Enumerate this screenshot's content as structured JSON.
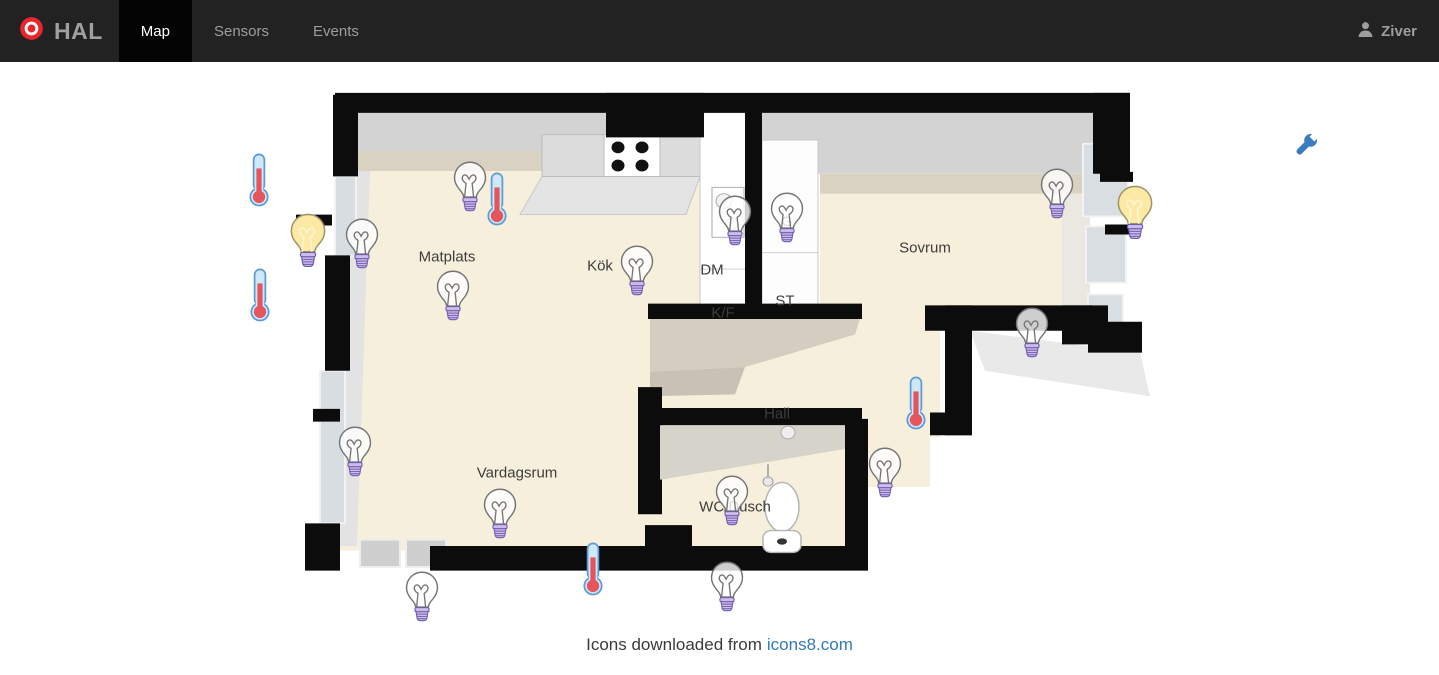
{
  "navbar": {
    "brand": "HAL",
    "brand_icon": "target-logo-icon",
    "tabs": [
      {
        "label": "Map",
        "active": true
      },
      {
        "label": "Sensors",
        "active": false
      },
      {
        "label": "Events",
        "active": false
      }
    ],
    "user": {
      "name": "Ziver",
      "icon": "person-icon"
    }
  },
  "map": {
    "tool_button": {
      "icon": "wrench-icon",
      "color": "#3a7cbf"
    },
    "room_labels": [
      {
        "text": "Matplats",
        "x": 447,
        "y": 257
      },
      {
        "text": "Kök",
        "x": 600,
        "y": 266
      },
      {
        "text": "DM",
        "x": 712,
        "y": 270
      },
      {
        "text": "K/F",
        "x": 723,
        "y": 313
      },
      {
        "text": "ST",
        "x": 785,
        "y": 301
      },
      {
        "text": "G",
        "x": 787,
        "y": 221,
        "small": true
      },
      {
        "text": "Sovrum",
        "x": 925,
        "y": 248
      },
      {
        "text": "Hall",
        "x": 777,
        "y": 414
      },
      {
        "text": "Vardagsrum",
        "x": 517,
        "y": 473
      },
      {
        "text": "WC/Dusch",
        "x": 735,
        "y": 507
      }
    ],
    "sensors": [
      {
        "id": "light-matplats-window",
        "type": "light",
        "state": "off",
        "x": 470,
        "y": 187
      },
      {
        "id": "light-matplats-wall-on",
        "type": "light",
        "state": "on",
        "x": 308,
        "y": 241
      },
      {
        "id": "light-matplats-wall",
        "type": "light",
        "state": "off",
        "x": 362,
        "y": 244
      },
      {
        "id": "light-matplats",
        "type": "light",
        "state": "off",
        "x": 453,
        "y": 296
      },
      {
        "id": "light-kok",
        "type": "light",
        "state": "off",
        "x": 637,
        "y": 271
      },
      {
        "id": "light-dm",
        "type": "light",
        "state": "off",
        "x": 735,
        "y": 221
      },
      {
        "id": "light-garderob",
        "type": "light",
        "state": "off",
        "x": 787,
        "y": 218
      },
      {
        "id": "light-sovrum-1",
        "type": "light",
        "state": "off",
        "x": 1057,
        "y": 194
      },
      {
        "id": "light-sovrum-window",
        "type": "light",
        "state": "on",
        "x": 1135,
        "y": 213
      },
      {
        "id": "light-sovrum-2",
        "type": "light",
        "state": "off",
        "x": 1032,
        "y": 333
      },
      {
        "id": "light-vardagsrum-window",
        "type": "light",
        "state": "off",
        "x": 355,
        "y": 452
      },
      {
        "id": "light-vardagsrum",
        "type": "light",
        "state": "off",
        "x": 500,
        "y": 514
      },
      {
        "id": "light-vardagsrum-bottom",
        "type": "light",
        "state": "off",
        "x": 422,
        "y": 597
      },
      {
        "id": "light-hall",
        "type": "light",
        "state": "off",
        "x": 885,
        "y": 473
      },
      {
        "id": "light-wc",
        "type": "light",
        "state": "off",
        "x": 732,
        "y": 501
      },
      {
        "id": "light-wc-bottom",
        "type": "light",
        "state": "off",
        "x": 727,
        "y": 587
      },
      {
        "id": "temp-left-upper",
        "type": "temperature",
        "x": 259,
        "y": 180
      },
      {
        "id": "temp-left-lower",
        "type": "temperature",
        "x": 260,
        "y": 295
      },
      {
        "id": "temp-matplats",
        "type": "temperature",
        "x": 497,
        "y": 199
      },
      {
        "id": "temp-hall",
        "type": "temperature",
        "x": 916,
        "y": 403
      },
      {
        "id": "temp-vardagsrum",
        "type": "temperature",
        "x": 593,
        "y": 569
      }
    ]
  },
  "footer": {
    "text": "Icons downloaded from",
    "link_text": "icons8.com"
  },
  "colors": {
    "navbar_bg": "#222222",
    "active_tab_bg": "#040404",
    "nav_text": "#9d9d9d",
    "brand_red": "#e9262a",
    "link_blue": "#337ab7",
    "wrench_blue": "#3a7cbf",
    "floor_cream": "#f6efdb",
    "ceiling_band": "#d9d2c2",
    "wall_black": "#0c0c0c",
    "bulb_on_yellow": "#fbe9a4",
    "bulb_base_purple": "#cdbce9",
    "thermometer_red": "#e4555c",
    "thermometer_tube_blue": "#cfe8f8"
  }
}
